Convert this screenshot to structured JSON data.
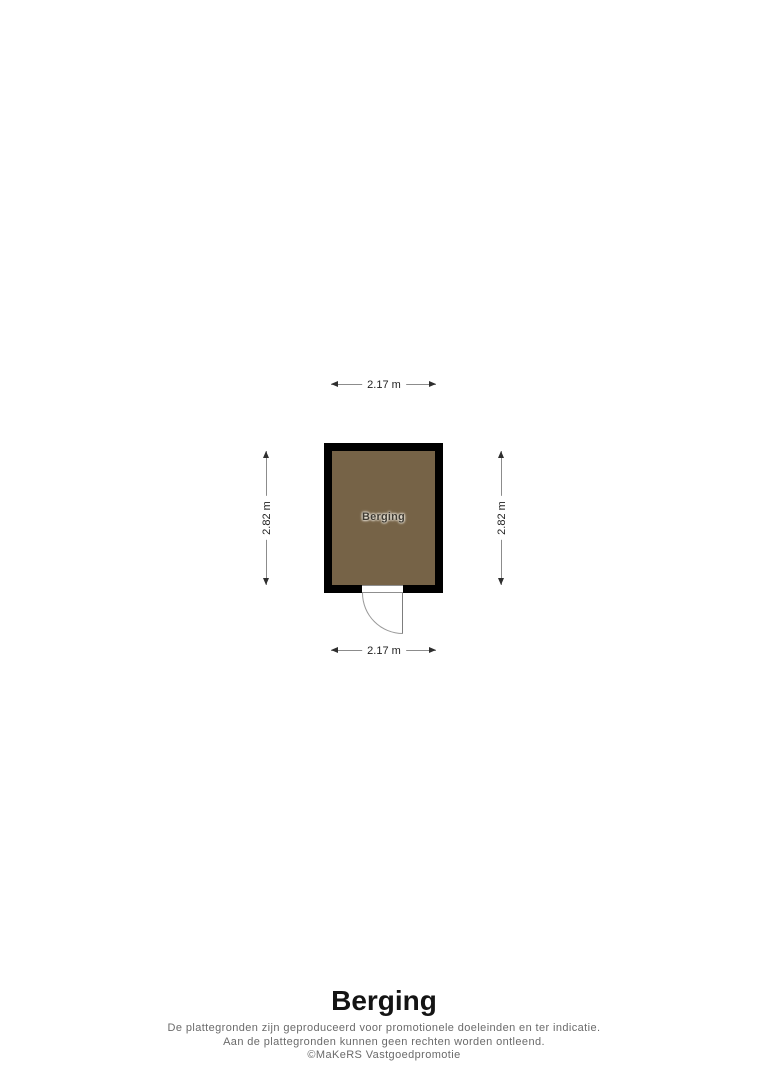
{
  "floorplan": {
    "room": {
      "label": "Berging",
      "fill_color": "#766347",
      "wall_color": "#000000"
    },
    "dimensions": {
      "width_top": "2.17 m",
      "width_bottom": "2.17 m",
      "height_left": "2.82 m",
      "height_right": "2.82 m"
    }
  },
  "caption": {
    "title": "Berging",
    "disclaimer_line1": "De plattegronden zijn geproduceerd voor promotionele doeleinden en ter indicatie.",
    "disclaimer_line2": "Aan de plattegronden kunnen geen rechten worden ontleend.",
    "credit": "©MaKeRS Vastgoedpromotie"
  }
}
